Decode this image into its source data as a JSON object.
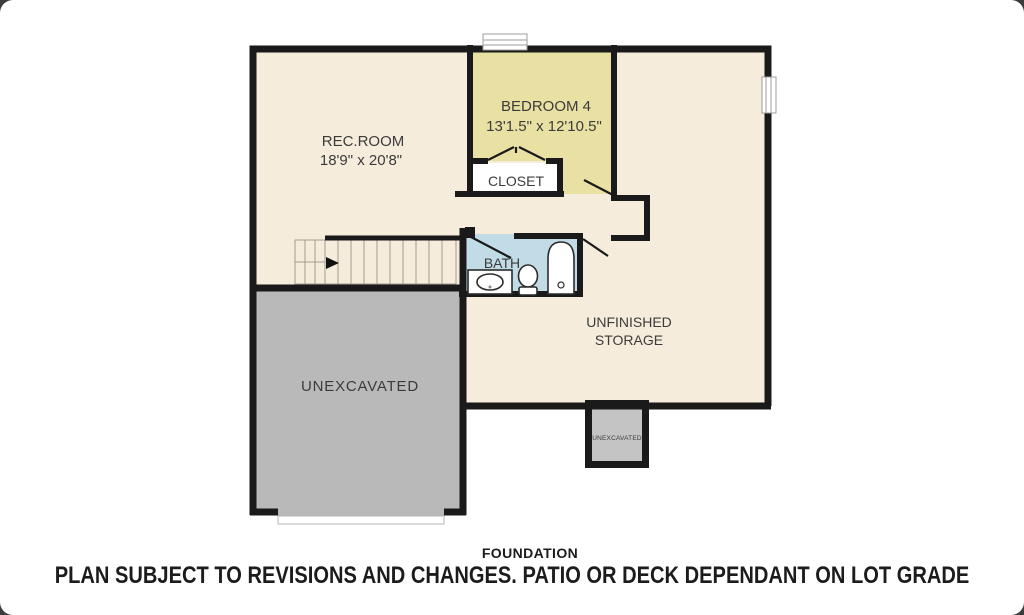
{
  "page": {
    "type": "floor-plan-image",
    "corner_backdrop_color": "#3c3c3c"
  },
  "plan": {
    "colors": {
      "wall": "#1a1a1a",
      "floor_main": "#f6ecdb",
      "floor_bedroom": "#e8e1a3",
      "floor_bath": "#c2dce7",
      "floor_closet": "#ffffff",
      "floor_unexcavated": "#b9b9b9",
      "floor_unexcavated_small": "#c4c4c4"
    },
    "rooms": {
      "rec_room": {
        "name": "REC.ROOM",
        "dims": "18'9\" x 20'8\""
      },
      "bedroom4": {
        "name": "BEDROOM 4",
        "dims": "13'1.5\" x 12'10.5\""
      },
      "closet": {
        "name": "CLOSET"
      },
      "bath": {
        "name": "BATH"
      },
      "storage": {
        "name_line1": "UNFINISHED",
        "name_line2": "STORAGE"
      },
      "unexcavated_main": {
        "name": "UNEXCAVATED"
      },
      "unexcavated_small": {
        "name": "UNEXCAVATED"
      }
    }
  },
  "footer": {
    "level_label": "FOUNDATION",
    "disclaimer": "PLAN SUBJECT TO REVISIONS AND CHANGES. PATIO OR DECK DEPENDANT ON LOT GRADE"
  }
}
